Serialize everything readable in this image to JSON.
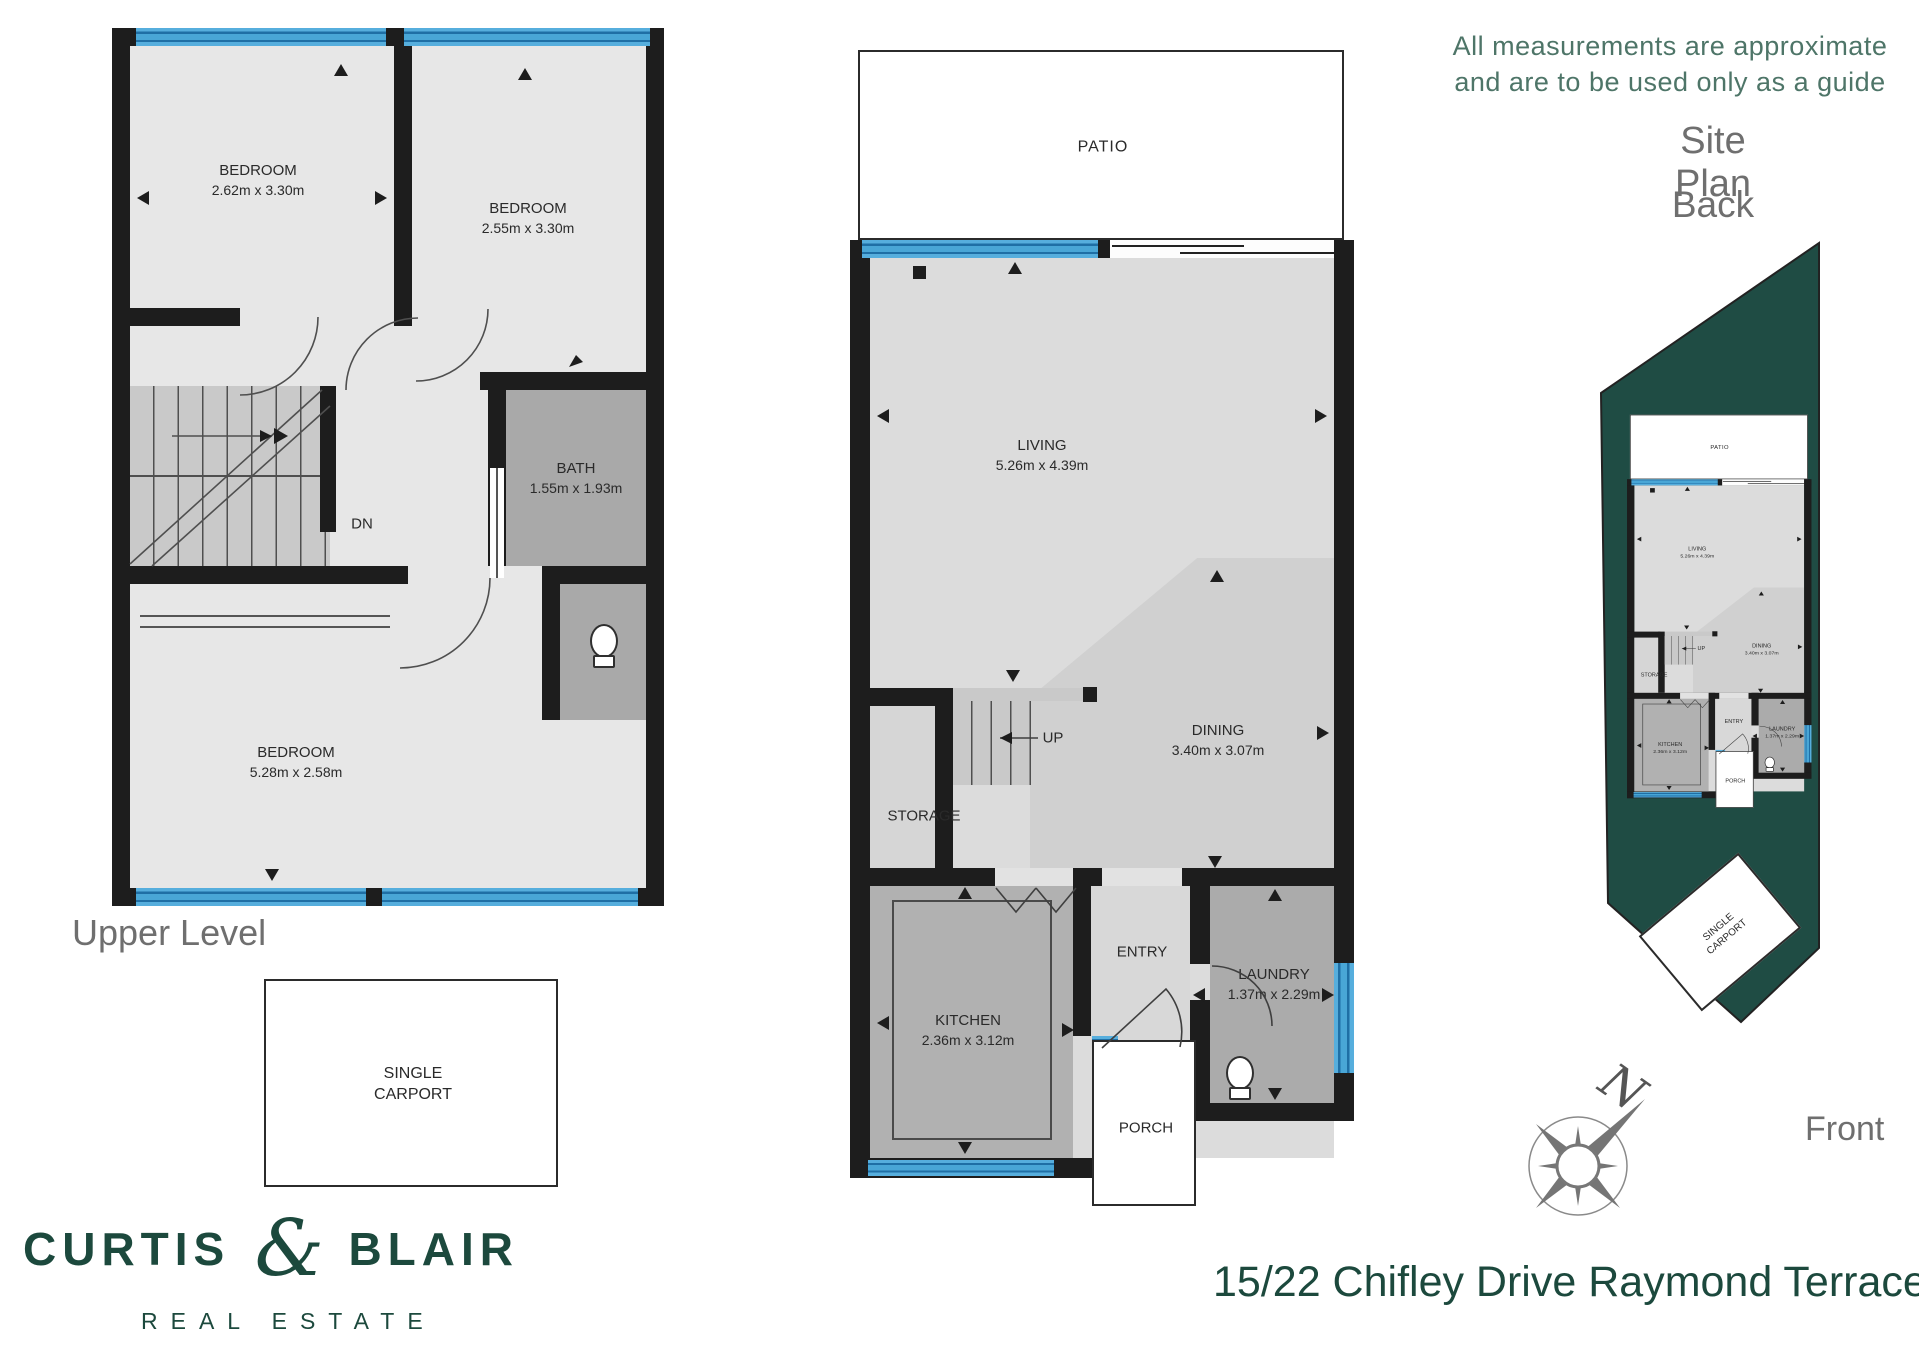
{
  "disclaimer": {
    "line1": "All measurements are approximate",
    "line2": "and are to be used only as a guide"
  },
  "site_plan": {
    "title": "Site Plan",
    "back": "Back",
    "front": "Front"
  },
  "upper": {
    "title": "Upper Level",
    "bedroom1_name": "BEDROOM",
    "bedroom1_dims": "2.62m x 3.30m",
    "bedroom2_name": "BEDROOM",
    "bedroom2_dims": "2.55m x 3.30m",
    "bath_name": "BATH",
    "bath_dims": "1.55m x 1.93m",
    "bedroom3_name": "BEDROOM",
    "bedroom3_dims": "5.28m x 2.58m",
    "stair_label": "DN"
  },
  "ground": {
    "patio": "PATIO",
    "living_name": "LIVING",
    "living_dims": "5.26m x 4.39m",
    "dining_name": "DINING",
    "dining_dims": "3.40m x 3.07m",
    "stair_label": "UP",
    "storage": "STORAGE",
    "kitchen_name": "KITCHEN",
    "kitchen_dims": "2.36m x 3.12m",
    "entry": "ENTRY",
    "laundry_name": "LAUNDRY",
    "laundry_dims": "1.37m x 2.29m",
    "porch": "PORCH"
  },
  "carport": {
    "line1": "SINGLE",
    "line2": "CARPORT"
  },
  "compass": {
    "north": "N"
  },
  "brand": {
    "name1": "CURTIS",
    "amp": "&",
    "name2": "BLAIR",
    "tagline": "REAL ESTATE",
    "address": "15/22 Chifley Drive Raymond Terrace"
  },
  "colors": {
    "brand_green": "#1c493d",
    "site_green": "#1f4c44",
    "window_blue": "#49a6d6",
    "wall_black": "#1d1d1d",
    "disclaimer_green": "#4e7568",
    "gray_text": "#6f6f6f"
  }
}
